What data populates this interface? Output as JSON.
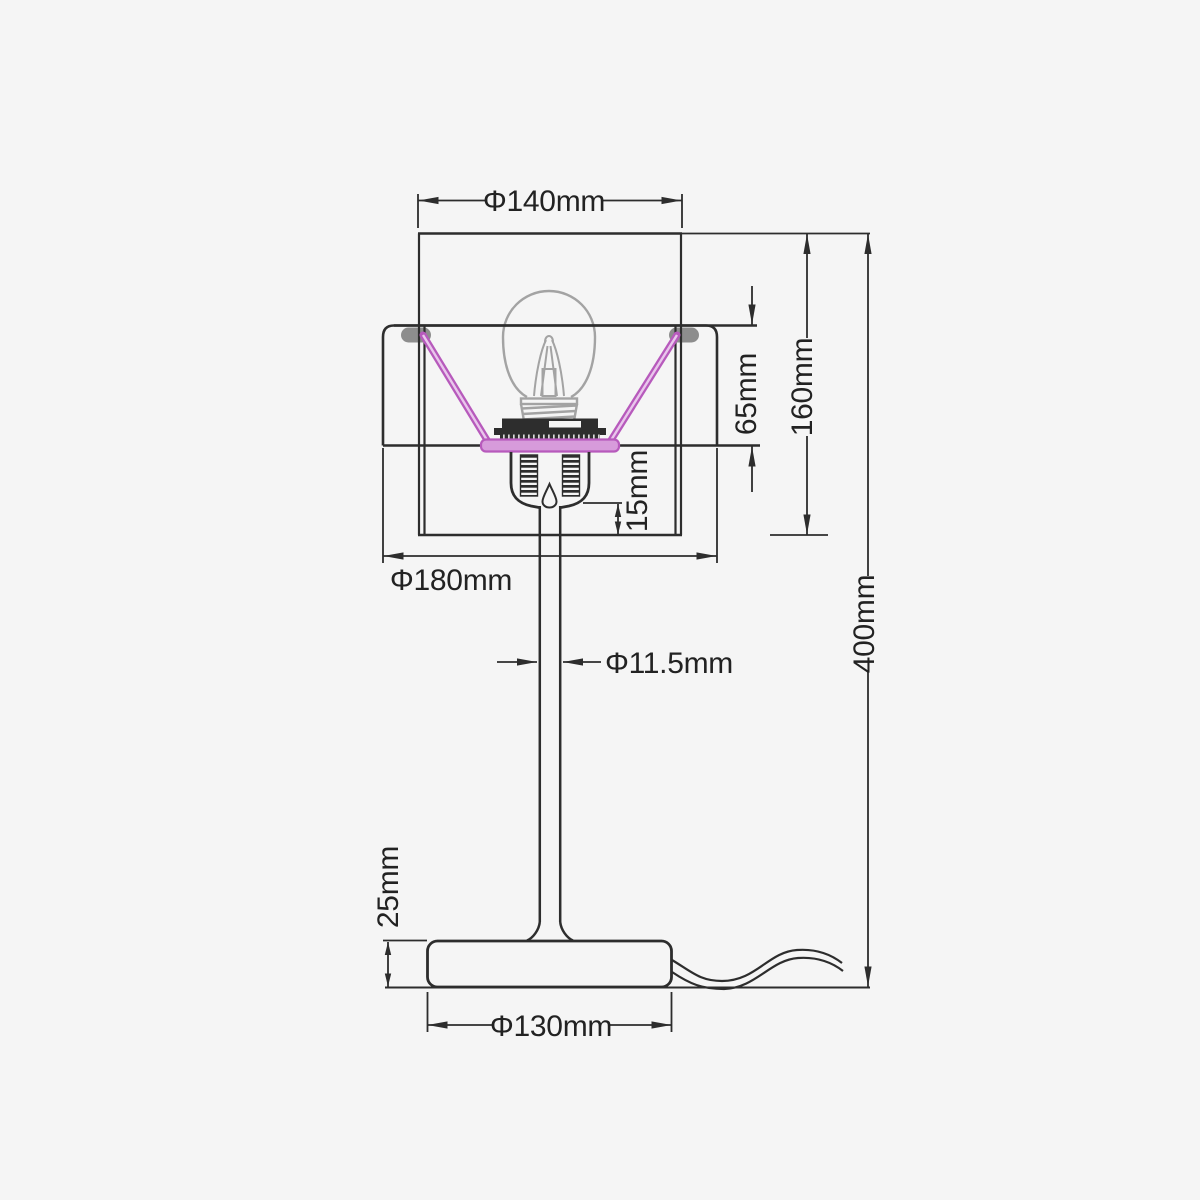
{
  "diagram": {
    "type": "technical-dimension-drawing",
    "subject": "table lamp front elevation",
    "dimensions": {
      "shade_top_diameter": "Φ140mm",
      "shade_height": "160mm",
      "shade_inset_depth": "65mm",
      "socket_clearance": "15mm",
      "shade_bottom_diameter": "Φ180mm",
      "stem_diameter": "Φ11.5mm",
      "total_height": "400mm",
      "base_height": "25mm",
      "base_diameter": "Φ130mm"
    },
    "colors": {
      "line": "#2d2d2d",
      "bulb_gray": "#a3a3a3",
      "support_pink": "#b75abc",
      "support_pink_fill": "#d79bdb",
      "background": "#f5f5f5"
    }
  }
}
